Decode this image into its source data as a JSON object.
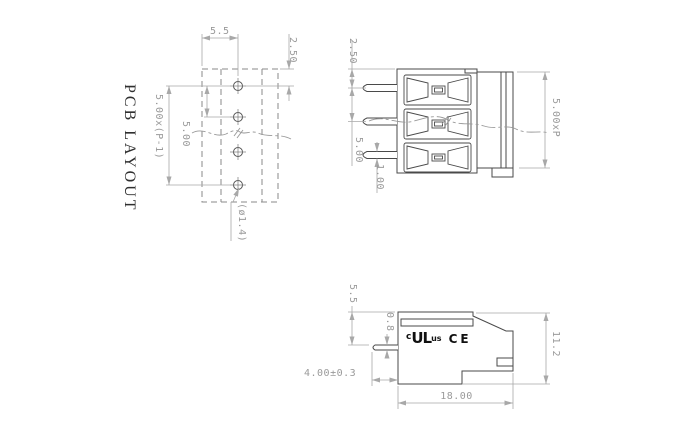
{
  "colors": {
    "object_line": "#4a4a4a",
    "dashed_line": "#8a8a8a",
    "dimension_line": "#a8a8a8",
    "dimension_text": "#9a9a9a",
    "label_text": "#2f2f2f",
    "cert_text": "#101010",
    "background": "#ffffff"
  },
  "pcb_layout": {
    "title": "PCB LAYOUT",
    "dim_pad_col_offset": "5.5",
    "dim_first_pad": "2.50",
    "dim_total_pitch": "5.00x(P-1)",
    "dim_pitch": "5.00",
    "dim_hole_diameter": "(ø1.4)",
    "hole_count": 4
  },
  "front_view": {
    "dim_pin_offset": "2.50",
    "dim_pin_pitch": "5.00",
    "dim_pin_width": "1.00",
    "dim_body_length": "5.00xP",
    "pole_count": 3
  },
  "side_view": {
    "dim_top_to_pin": "5.5",
    "dim_pin_thickness": "0.8",
    "dim_pin_length": "4.00±0.3",
    "dim_body_height": "11.2",
    "dim_body_depth": "18.00",
    "cert_c": "c",
    "cert_ul": "UL",
    "cert_us": "us",
    "cert_ce": "CE"
  }
}
